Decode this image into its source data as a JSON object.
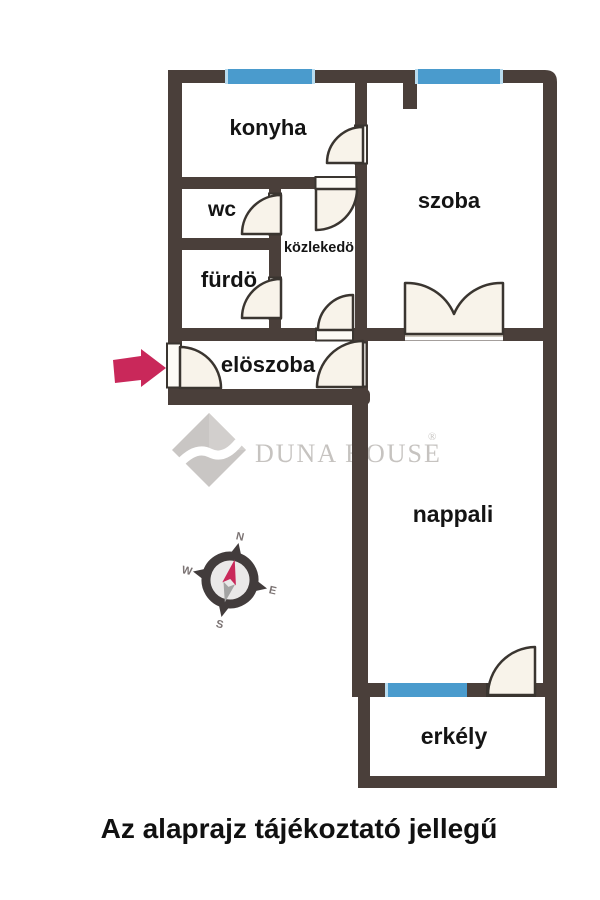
{
  "caption": "Az alaprajz tájékoztató jellegű",
  "rooms": {
    "konyha": "konyha",
    "wc": "wc",
    "kozlekedo": "közlekedö",
    "furdo": "fürdö",
    "szoba": "szoba",
    "eloszoba": "elöszoba",
    "nappali": "nappali",
    "erkely": "erkély"
  },
  "logo": {
    "brand": "Duna House",
    "text": "DUNA HOUSE",
    "registered": "®"
  },
  "compass": {
    "north": "N",
    "east": "E",
    "south": "S",
    "west": "W"
  },
  "colors": {
    "wall": "#4a3f3a",
    "window": "#4a9bcd",
    "door_fill": "#f8f3ea",
    "door_stroke": "#3a3530",
    "balcony_panel": "#ddd7cb",
    "arrow": "#c9285a",
    "logo_gray": "#c6c3c0",
    "label_text": "#141414"
  }
}
